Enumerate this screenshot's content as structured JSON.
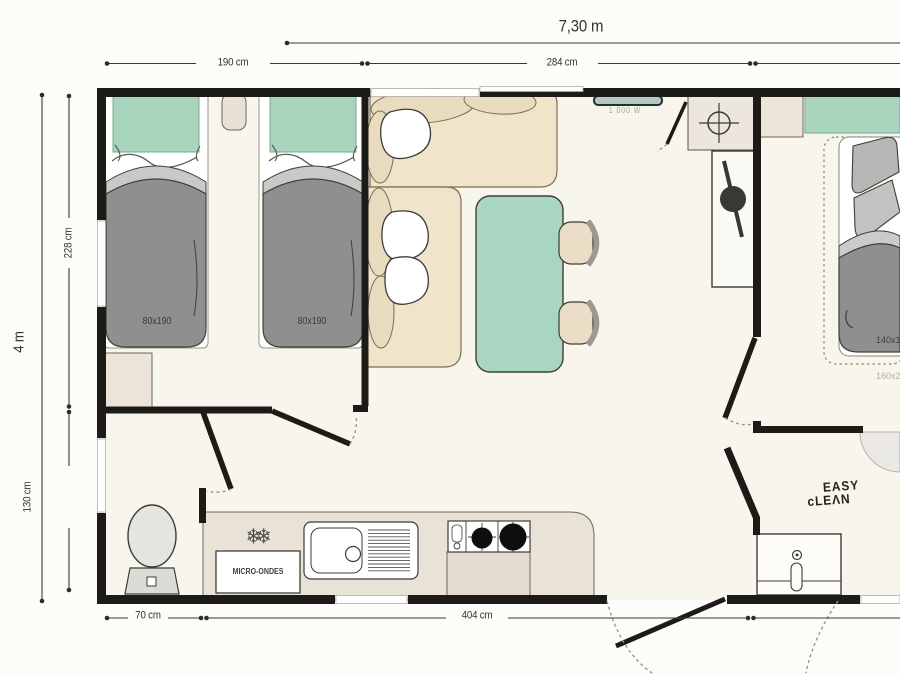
{
  "plan": {
    "dims": {
      "overall_width": "7,30 m",
      "overall_depth": "4 m",
      "top_segment_1": "190 cm",
      "top_segment_2": "284 cm",
      "left_segment_1": "228 cm",
      "left_segment_2": "130 cm",
      "bottom_segment_1": "70 cm",
      "bottom_segment_2": "404 cm"
    },
    "bedroom_twin": {
      "bed_a_size": "80x190",
      "bed_b_size": "80x190"
    },
    "bedroom_double": {
      "bed_size": "140x19",
      "mattress_outline_size": "160x2"
    },
    "living": {
      "heater_power": "1 000 W"
    },
    "kitchen": {
      "microwave_label": "MICRO-ONDES",
      "fridge_icon": "❄❄"
    },
    "branding": {
      "line1": "EASY",
      "line2": "cLEΛN"
    },
    "colors": {
      "wall": "#1c1b18",
      "floor": "#f7f5ec",
      "mint": "#a9d4be",
      "sofa_beige": "#f0e4ca",
      "duvet_gray": "#8f8f8f",
      "counter_beige": "#e8e2d7"
    }
  }
}
